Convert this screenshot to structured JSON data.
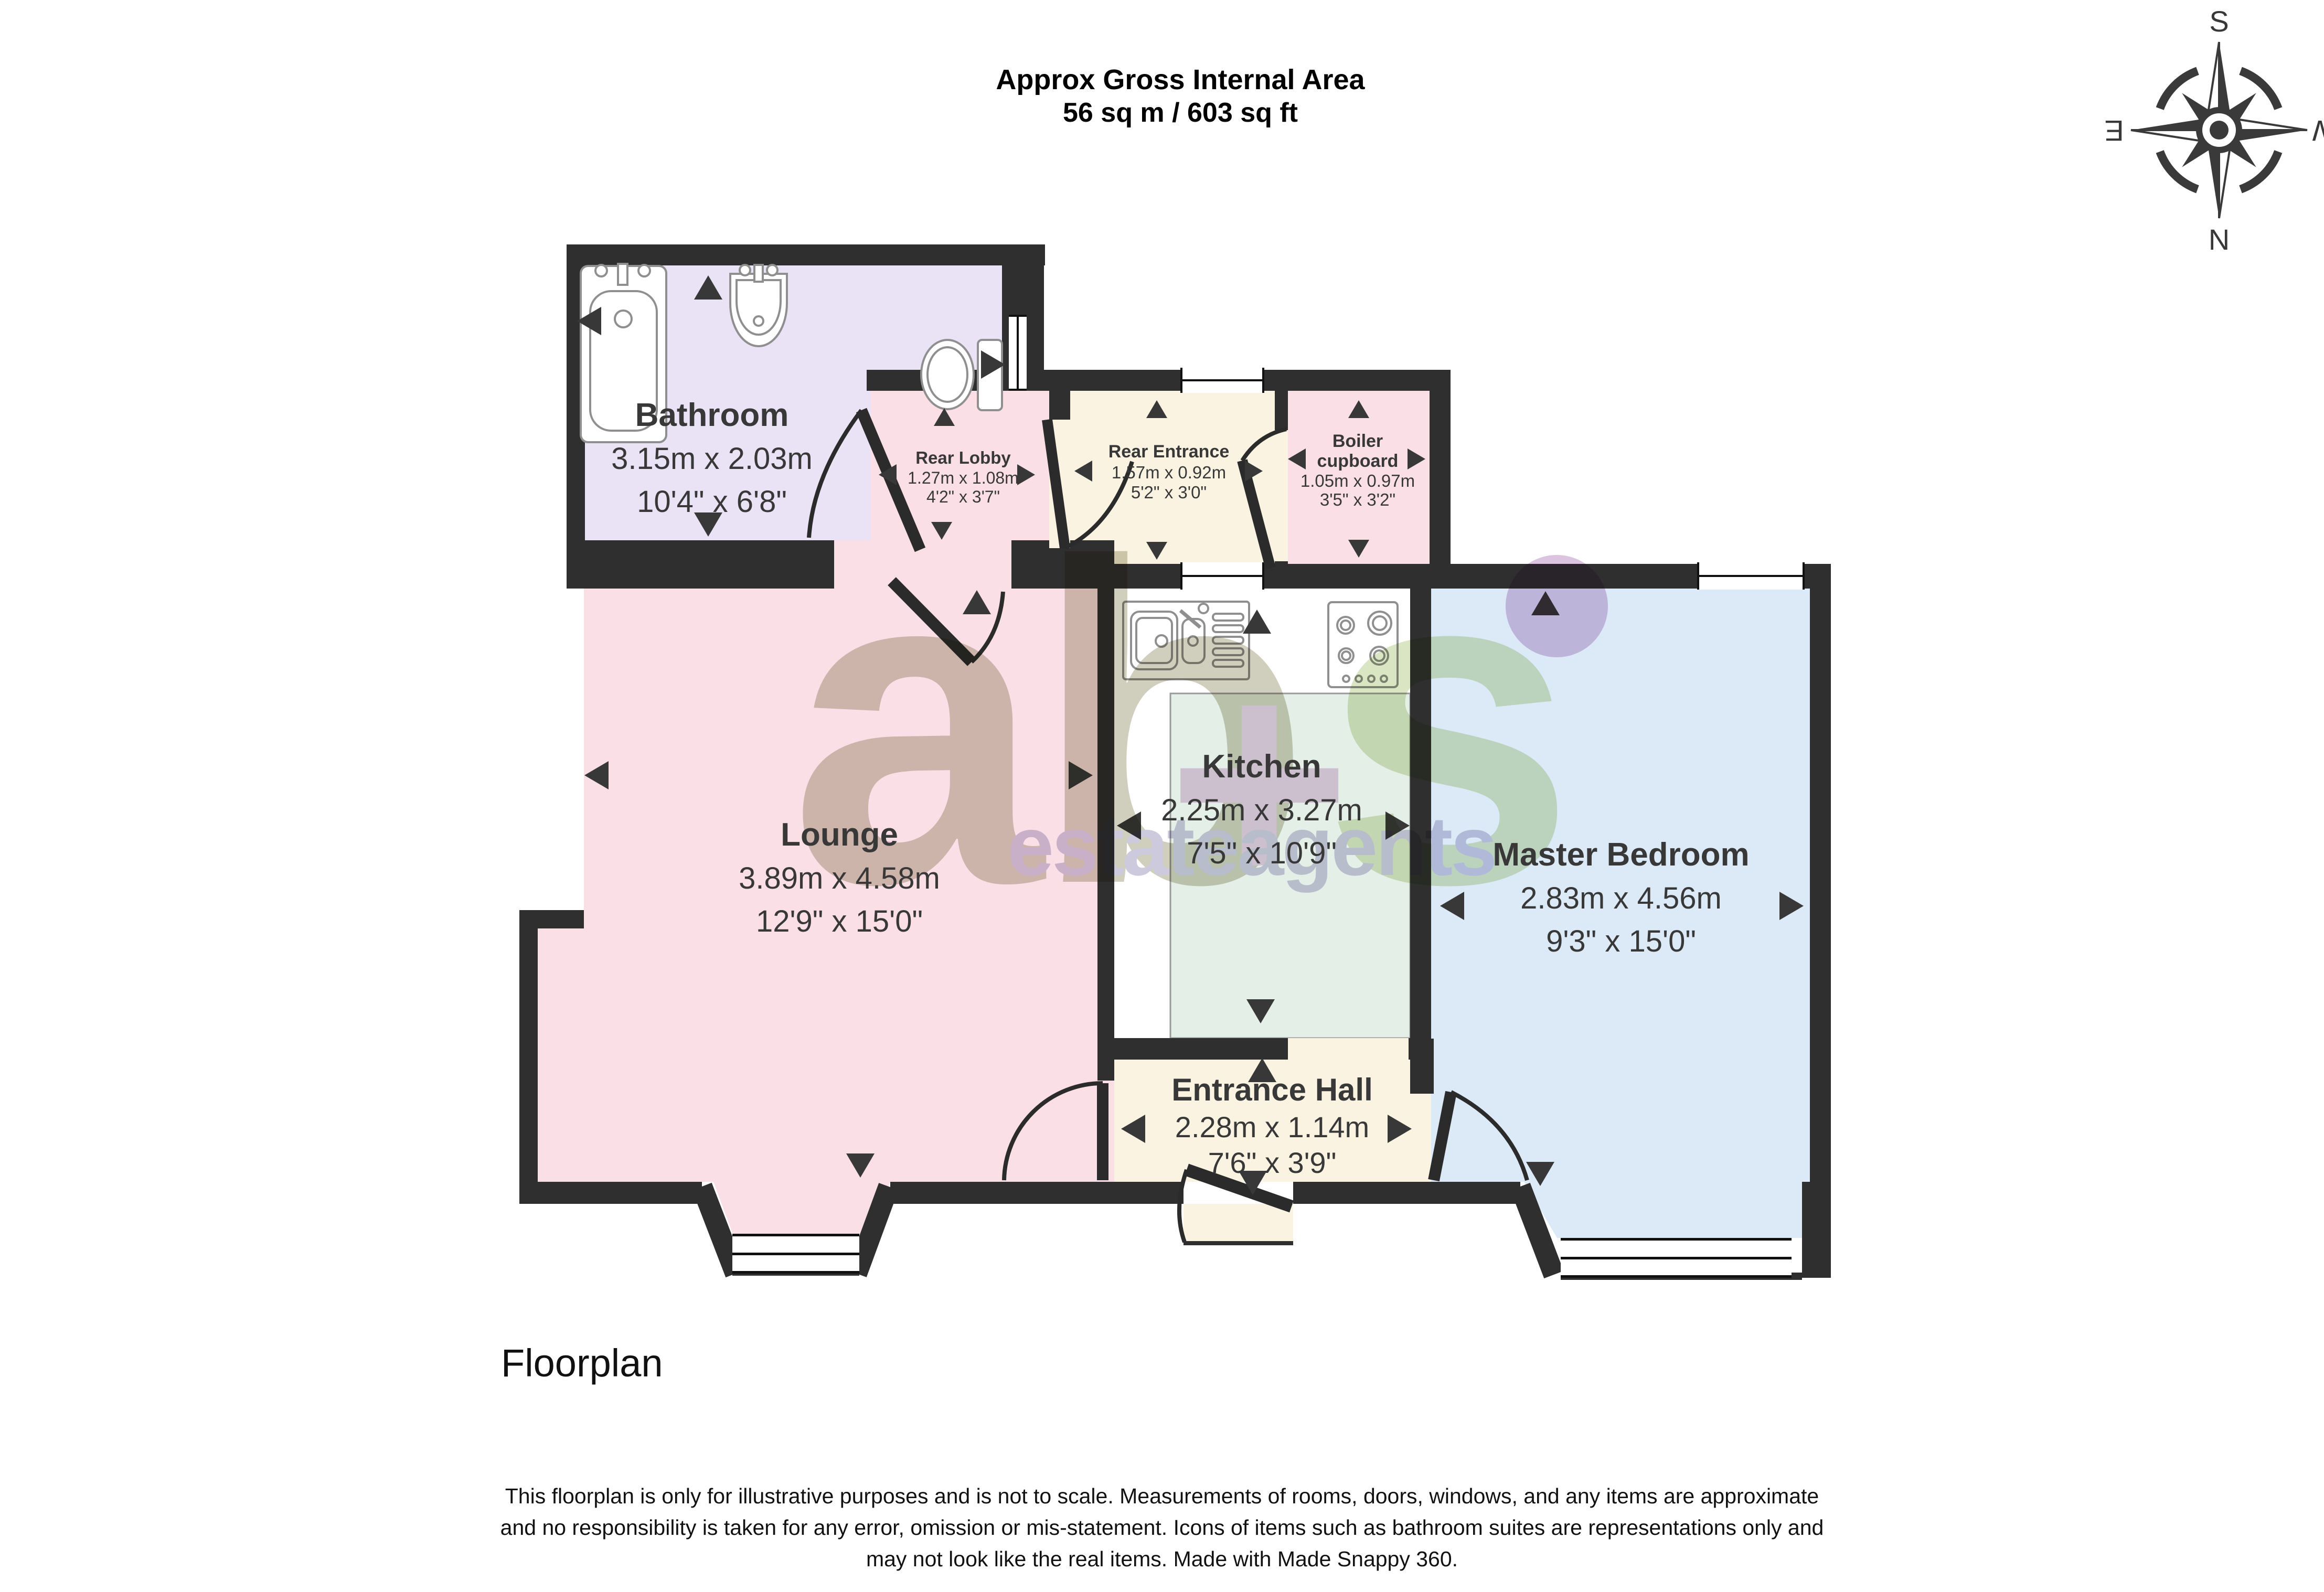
{
  "title": {
    "line1": "Approx Gross Internal Area",
    "line2": "56 sq m / 603 sq ft"
  },
  "compass": {
    "n": "N",
    "s": "S",
    "e": "E",
    "w": "W"
  },
  "rooms": {
    "bathroom": {
      "name": "Bathroom",
      "metric": "3.15m x 2.03m",
      "imperial": "10'4\" x 6'8\""
    },
    "rear_lobby": {
      "name": "Rear Lobby",
      "metric": "1.27m x 1.08m",
      "imperial": "4'2\" x 3'7\""
    },
    "rear_entrance": {
      "name": "Rear Entrance",
      "metric": "1.57m x 0.92m",
      "imperial": "5'2\" x 3'0\""
    },
    "boiler_cupboard": {
      "name_line1": "Boiler",
      "name_line2": "cupboard",
      "metric": "1.05m x 0.97m",
      "imperial": "3'5\" x 3'2\""
    },
    "lounge": {
      "name": "Lounge",
      "metric": "3.89m x 4.58m",
      "imperial": "12'9\" x 15'0\""
    },
    "kitchen": {
      "name": "Kitchen",
      "metric": "2.25m x 3.27m",
      "imperial": "7'5\" x 10'9\""
    },
    "master_bedroom": {
      "name": "Master Bedroom",
      "metric": "2.83m x 4.56m",
      "imperial": "9'3\" x 15'0\""
    },
    "entrance_hall": {
      "name": "Entrance Hall",
      "metric": "2.28m x 1.14m",
      "imperial": "7'6\" x 3'9\""
    }
  },
  "watermark": {
    "logo_ab": "ab",
    "logo_plus": "+",
    "logo_s": "s",
    "tagline": "estateagents"
  },
  "footer": {
    "caption": "Floorplan",
    "disclaimer_line1": "This floorplan is only for illustrative purposes and is not to scale. Measurements of rooms, doors, windows, and any items are approximate",
    "disclaimer_line2": "and no responsibility is taken for any error, omission or mis-statement. Icons of items such as bathroom suites are representations only and",
    "disclaimer_line3": "may not look like the real items. Made with Made Snappy 360."
  },
  "colors": {
    "wall": "#2f2f2f",
    "bathroom_fill": "#e9e3f5",
    "pink_fill": "#fbdfe7",
    "cream_fill": "#faf3e2",
    "kitchen_fill": "#e4efe8",
    "bedroom_fill": "#dceaf8",
    "fixture_stroke": "#8f8f8f",
    "text": "#383838"
  }
}
